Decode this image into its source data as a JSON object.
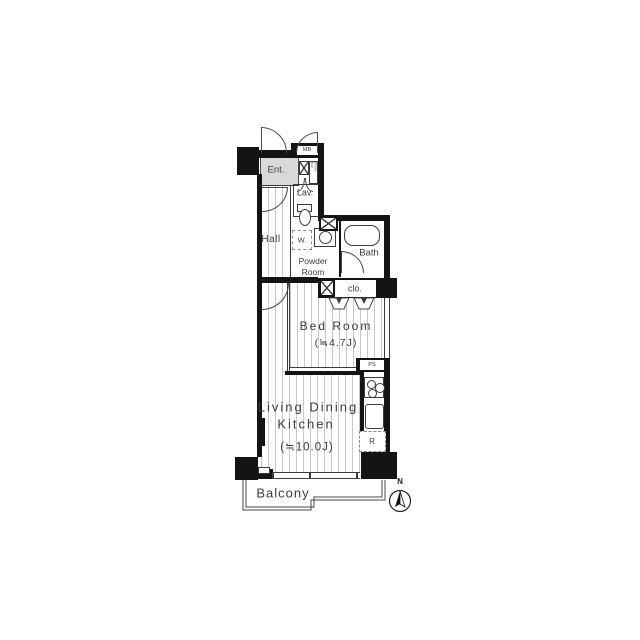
{
  "rooms": {
    "entrance": {
      "label": "Ent."
    },
    "lavatory": {
      "label": "Lav."
    },
    "hall": {
      "label": "Hall"
    },
    "powder": {
      "line1": "Powder",
      "line2": "Room"
    },
    "bath": {
      "label": "Bath"
    },
    "closet": {
      "label": "clo."
    },
    "bedroom": {
      "label": "Bed Room",
      "size": "(≒4.7J)"
    },
    "ldk": {
      "line1": "Living Dining",
      "line2": "Kitchen",
      "size": "(≒10.0J)"
    },
    "balcony": {
      "label": "Balcony"
    }
  },
  "fixtures": {
    "meter_box": "MB",
    "pipe_space": "PS",
    "refrigerator": "R",
    "washer": "W.",
    "shoes_box": "Shoes Box"
  },
  "compass": {
    "north": "N"
  },
  "colors": {
    "wall": "#141414",
    "line": "#3c3c3c",
    "text": "#3b3b3b",
    "floor_line": "#c9c9c9",
    "entrance_fill": "#d9d9d9"
  }
}
